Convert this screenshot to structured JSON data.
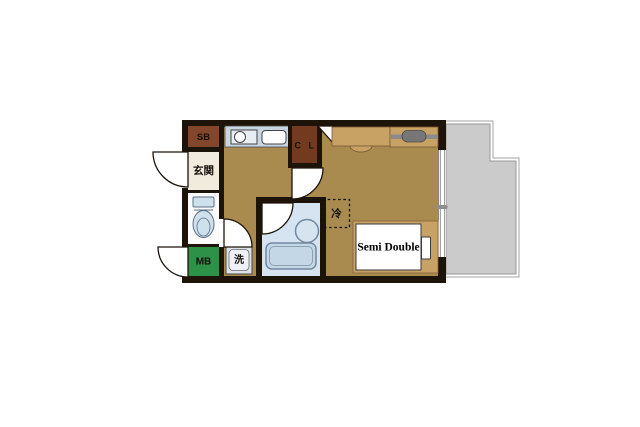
{
  "type": "floor-plan",
  "title": "Studio apartment floor plan",
  "labels": {
    "storage_box": "SB",
    "entrance": "玄関",
    "closet": "C L",
    "refrigerator": "冷",
    "bed": "Semi Double",
    "meter_box": "MB",
    "washing_machine": "洗"
  },
  "colors": {
    "wall": "#1c1309",
    "floor": "#a98a4f",
    "furniture_tan": "#c8a164",
    "entrance_floor": "#f0ebdd",
    "toilet_room_white": "#fbfbfb",
    "storage_brown": "#82462a",
    "closet_brown": "#723a1e",
    "meter_box_green": "#2e9148",
    "wet_area_blue": "#d5e4f0",
    "tub_blue": "#c3d7e7",
    "counter_blue": "#c9d6e2",
    "balcony_gray": "#cbcbcb",
    "fixture_gray": "#8b8b8b",
    "door_white": "#ffffff"
  }
}
